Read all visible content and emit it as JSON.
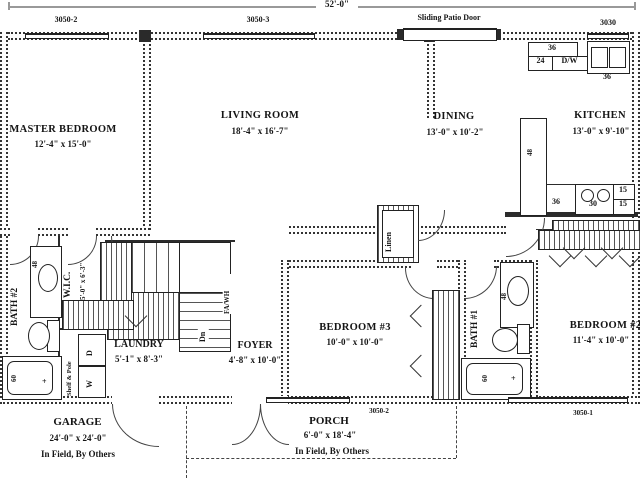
{
  "plan": {
    "overall_dim": "52'-0\"",
    "top": {
      "win1": "3050-2",
      "win2": "3050-3",
      "patio": "Sliding Patio Door",
      "win3": "3030"
    },
    "bottom": {
      "win1": "3050-2",
      "win2": "3050-1"
    },
    "rooms": {
      "master": {
        "name": "MASTER BEDROOM",
        "dims": "12'-4\" x 15'-0\""
      },
      "living": {
        "name": "LIVING ROOM",
        "dims": "18'-4\" x 16'-7\""
      },
      "dining": {
        "name": "DINING",
        "dims": "13'-0\" x 10'-2\""
      },
      "kitchen": {
        "name": "KITCHEN",
        "dims": "13'-0\" x 9'-10\""
      },
      "wic": {
        "name": "W.I.C.",
        "dims": "5'-0\" x 6'-3\""
      },
      "bath2": {
        "name": "BATH #2"
      },
      "laundry": {
        "name": "LAUNDRY",
        "dims": "5'-1\" x 8'-3\""
      },
      "foyer": {
        "name": "FOYER",
        "dims": "4'-8\" x 10'-0\""
      },
      "bedroom3": {
        "name": "BEDROOM #3",
        "dims": "10'-0\" x 10'-0\""
      },
      "bath1": {
        "name": "BATH #1"
      },
      "bedroom2": {
        "name": "BEDROOM #2",
        "dims": "11'-4\" x 10'-0\""
      },
      "garage": {
        "name": "GARAGE",
        "dims": "24'-0\" x 24'-0\"",
        "note": "In Field, By Others"
      },
      "porch": {
        "name": "PORCH",
        "dims": "6'-0\" x 18'-4\"",
        "note": "In Field, By Others"
      },
      "linen": {
        "name": "Linen"
      }
    },
    "kitchen_fix": {
      "cab36": "36",
      "cab24": "24",
      "dw": "D/W",
      "sink36": "36",
      "pantry48": "48",
      "counter36": "36",
      "range30": "30",
      "c15a": "15",
      "c15b": "15"
    },
    "bath2_fix": {
      "vanity": "48",
      "tub": "60",
      "faucet": "+"
    },
    "bath1_fix": {
      "vanity": "48",
      "tub": "60",
      "faucet": "+"
    },
    "laundry_fix": {
      "shelf": "Shelf & Pole",
      "dryer": "D",
      "washer": "W"
    },
    "stairs": {
      "dn": "Dn",
      "utility": "FA/WH"
    }
  }
}
